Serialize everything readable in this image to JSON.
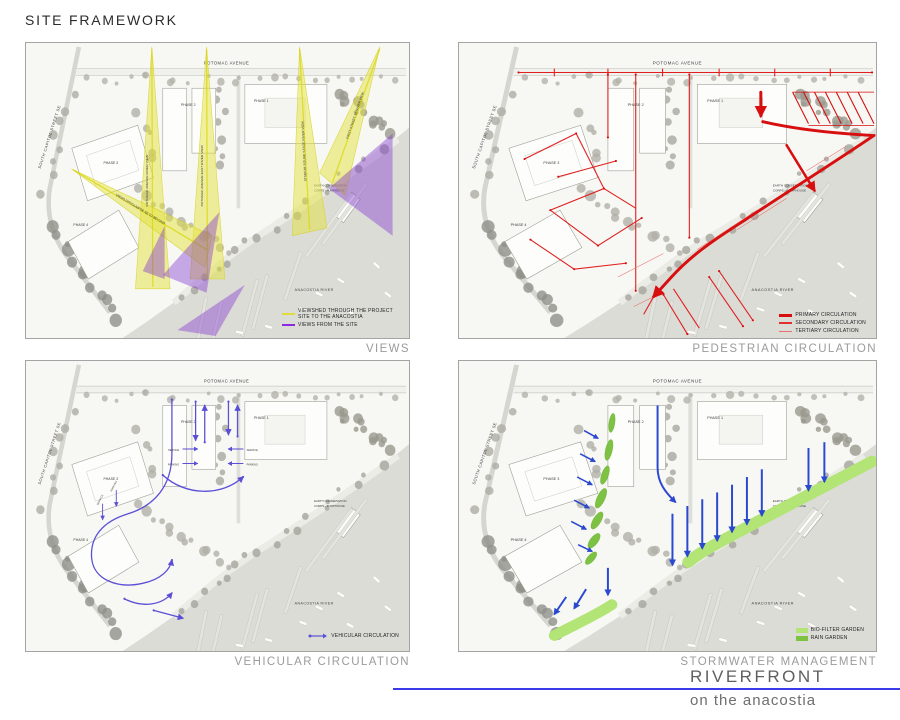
{
  "page": {
    "title": "SITE FRAMEWORK"
  },
  "footer": {
    "project": "RIVERFRONT",
    "subtitle": "on the anacostia",
    "line_color": "#3b3bea"
  },
  "map": {
    "street_top": "POTOMAC AVENUE",
    "street_left": "SOUTH CAPITOL STREET SE",
    "river": "ANACOSTIA RIVER",
    "phase1": "PHASE 1",
    "phase2": "PHASE 2",
    "phase3": "PHASE 3",
    "phase4": "PHASE 4",
    "ecc_line1": "EARTH CONSERVATION",
    "ecc_line2": "CORPS - PUMPHOUSE"
  },
  "panels": {
    "views": {
      "caption": "VIEWS",
      "cone_labels": [
        "POTOMAC AVENUE RIVER VIEW",
        "POTOMAC AVENUE EAST RIVER VIEW",
        "STADIUM SOUND STAGE RIVER VIEW",
        "FIRST STREET SE RIVER VIEW",
        "VIEWS OFF/GLIMPSE SE TO BEYOND"
      ],
      "legend": [
        {
          "label": "VIEWSHED THROUGH THE PROJECT SITE TO THE ANACOSTIA",
          "color": "#e0dd38"
        },
        {
          "label": "VIEWS FROM THE SITE",
          "color": "#8a2be2"
        }
      ]
    },
    "pedestrian": {
      "caption": "PEDESTRIAN CIRCULATION",
      "color": "#d80f0f",
      "legend": [
        {
          "label": "PRIMARY CIRCULATION",
          "weight": "primary"
        },
        {
          "label": "SECONDARY CIRCULATION",
          "weight": "secondary"
        },
        {
          "label": "TERTIARY CIRCULATION",
          "weight": "tertiary"
        }
      ]
    },
    "vehicular": {
      "caption": "VEHICULAR CIRCULATION",
      "color": "#5b4fd6",
      "annotations": {
        "service": "SERVICE",
        "parking": "PARKING"
      },
      "legend": [
        {
          "label": "VEHICULAR CIRCULATION"
        }
      ]
    },
    "stormwater": {
      "caption": "STORMWATER MANAGEMENT",
      "flow_color": "#2b49cf",
      "legend": [
        {
          "label": "BIO-FILTER GARDEN",
          "color": "#b2e476"
        },
        {
          "label": "RAIN GARDEN",
          "color": "#7dc242"
        }
      ]
    }
  }
}
